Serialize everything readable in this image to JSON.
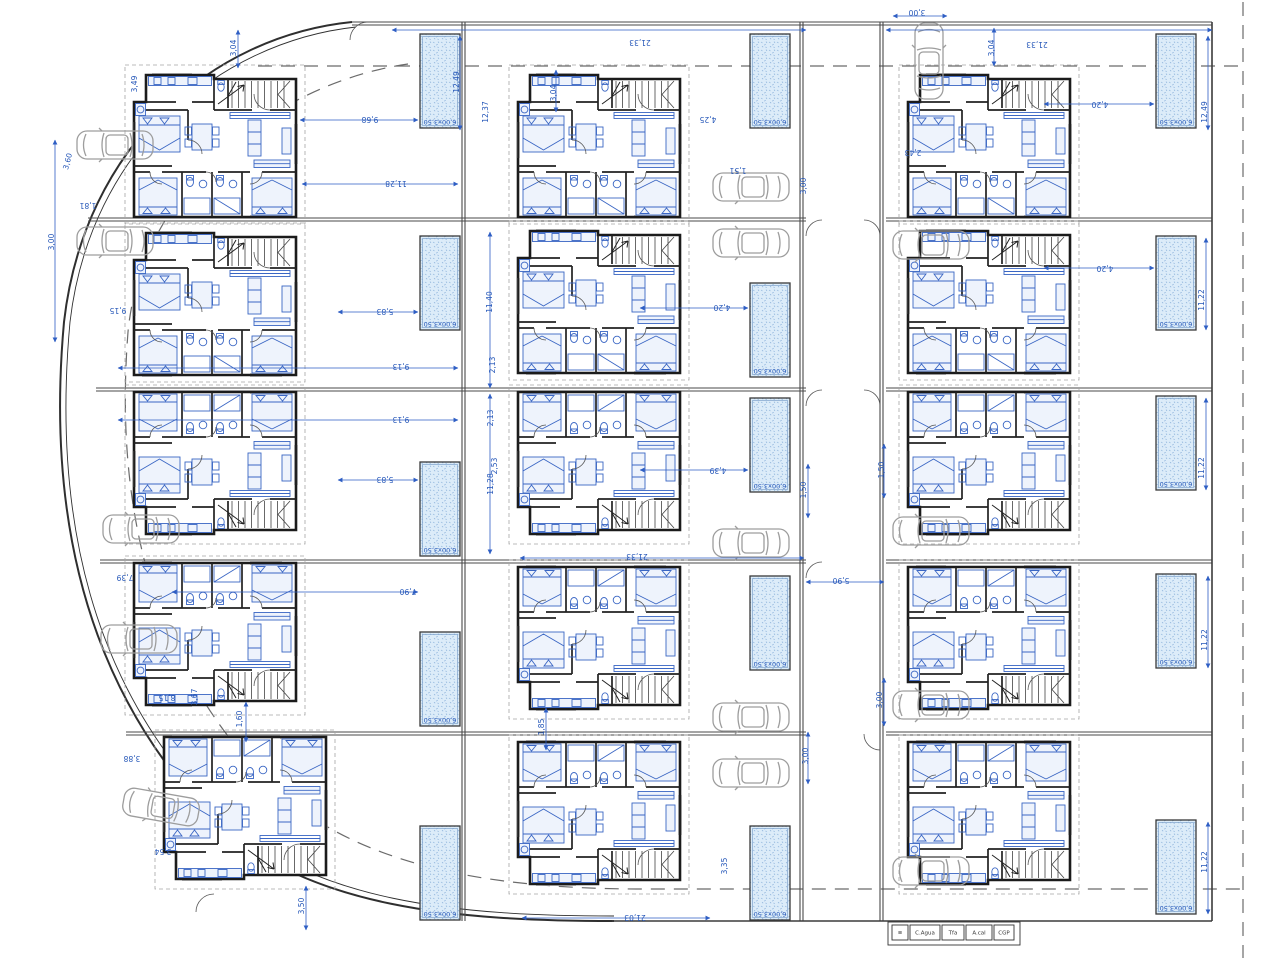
{
  "plan": {
    "width": 1280,
    "height": 960,
    "accent_blue": "#2e5ec4",
    "wall_black": "#1b1b1b",
    "car_gray": "#9d9d9d",
    "pool_fill": "#dcecf9",
    "pool_label": "6,00x3,50"
  },
  "houses": [
    {
      "x": 132,
      "y": 72,
      "flip": "n"
    },
    {
      "x": 132,
      "y": 230,
      "flip": "n"
    },
    {
      "x": 132,
      "y": 392,
      "flip": "v"
    },
    {
      "x": 132,
      "y": 563,
      "flip": "v"
    },
    {
      "x": 162,
      "y": 737,
      "flip": "v"
    },
    {
      "x": 516,
      "y": 72,
      "flip": "n"
    },
    {
      "x": 516,
      "y": 228,
      "flip": "n"
    },
    {
      "x": 516,
      "y": 392,
      "flip": "v"
    },
    {
      "x": 516,
      "y": 567,
      "flip": "v"
    },
    {
      "x": 516,
      "y": 742,
      "flip": "v"
    },
    {
      "x": 906,
      "y": 72,
      "flip": "n"
    },
    {
      "x": 906,
      "y": 228,
      "flip": "n"
    },
    {
      "x": 906,
      "y": 392,
      "flip": "v"
    },
    {
      "x": 906,
      "y": 567,
      "flip": "v"
    },
    {
      "x": 906,
      "y": 742,
      "flip": "v"
    }
  ],
  "cars": [
    {
      "x": 76,
      "y": 128,
      "r": 0
    },
    {
      "x": 76,
      "y": 224,
      "r": 0
    },
    {
      "x": 102,
      "y": 512,
      "r": 0
    },
    {
      "x": 100,
      "y": 622,
      "r": 0
    },
    {
      "x": 122,
      "y": 790,
      "r": 10
    },
    {
      "x": 712,
      "y": 170,
      "r": 0
    },
    {
      "x": 712,
      "y": 226,
      "r": 0
    },
    {
      "x": 712,
      "y": 526,
      "r": 0
    },
    {
      "x": 712,
      "y": 700,
      "r": 0
    },
    {
      "x": 712,
      "y": 756,
      "r": 0
    },
    {
      "x": 890,
      "y": 44,
      "r": 90
    },
    {
      "x": 892,
      "y": 228,
      "r": 0
    },
    {
      "x": 892,
      "y": 514,
      "r": 0
    },
    {
      "x": 892,
      "y": 688,
      "r": 0
    },
    {
      "x": 892,
      "y": 854,
      "r": 0
    }
  ],
  "pools": {
    "w": 40,
    "h": 94,
    "items": [
      {
        "x": 420,
        "y": 34
      },
      {
        "x": 420,
        "y": 236
      },
      {
        "x": 420,
        "y": 462
      },
      {
        "x": 420,
        "y": 632
      },
      {
        "x": 420,
        "y": 826
      },
      {
        "x": 750,
        "y": 34
      },
      {
        "x": 750,
        "y": 283
      },
      {
        "x": 750,
        "y": 398
      },
      {
        "x": 750,
        "y": 576
      },
      {
        "x": 750,
        "y": 826
      },
      {
        "x": 1156,
        "y": 34
      },
      {
        "x": 1156,
        "y": 236
      },
      {
        "x": 1156,
        "y": 396
      },
      {
        "x": 1156,
        "y": 574
      },
      {
        "x": 1156,
        "y": 820
      }
    ]
  },
  "dims": [
    {
      "x": 236,
      "y": 48,
      "t": "3,04",
      "r": -90
    },
    {
      "x": 137,
      "y": 84,
      "t": "3,49",
      "r": -90
    },
    {
      "x": 640,
      "y": 40,
      "t": "21,33",
      "r": 180
    },
    {
      "x": 556,
      "y": 93,
      "t": "3,04",
      "r": -90
    },
    {
      "x": 1037,
      "y": 42,
      "t": "21,33",
      "r": 180
    },
    {
      "x": 994,
      "y": 48,
      "t": "3,04",
      "r": -90
    },
    {
      "x": 917,
      "y": 10,
      "t": "3,00",
      "r": 180
    },
    {
      "x": 70,
      "y": 162,
      "t": "3,60",
      "r": -75
    },
    {
      "x": 88,
      "y": 203,
      "t": "1,81",
      "r": 180
    },
    {
      "x": 54,
      "y": 242,
      "t": "3,00",
      "r": -90
    },
    {
      "x": 370,
      "y": 117,
      "t": "9,68",
      "r": 180
    },
    {
      "x": 396,
      "y": 181,
      "t": "11,28",
      "r": 180
    },
    {
      "x": 385,
      "y": 309,
      "t": "5,83",
      "r": 180
    },
    {
      "x": 401,
      "y": 364,
      "t": "9,13",
      "r": 180
    },
    {
      "x": 401,
      "y": 417,
      "t": "9,13",
      "r": 180
    },
    {
      "x": 385,
      "y": 477,
      "t": "5,83",
      "r": 180
    },
    {
      "x": 408,
      "y": 589,
      "t": "7,90",
      "r": 180
    },
    {
      "x": 738,
      "y": 168,
      "t": "1,51",
      "r": 180
    },
    {
      "x": 806,
      "y": 186,
      "t": "3,00",
      "r": -90
    },
    {
      "x": 841,
      "y": 578,
      "t": "5,90",
      "r": 180
    },
    {
      "x": 637,
      "y": 554,
      "t": "21,33",
      "r": 180
    },
    {
      "x": 635,
      "y": 915,
      "t": "21,03",
      "r": 180
    },
    {
      "x": 544,
      "y": 727,
      "t": "1,85",
      "r": -90
    },
    {
      "x": 242,
      "y": 719,
      "t": "1,60",
      "r": -90
    },
    {
      "x": 132,
      "y": 756,
      "t": "3,88",
      "r": 180
    },
    {
      "x": 163,
      "y": 849,
      "t": "3,54",
      "r": 180
    },
    {
      "x": 304,
      "y": 906,
      "t": "3,50",
      "r": -90
    },
    {
      "x": 459,
      "y": 82,
      "t": "12,49",
      "r": -90
    },
    {
      "x": 1207,
      "y": 112,
      "t": "12,49",
      "r": -90
    },
    {
      "x": 1204,
      "y": 300,
      "t": "11,22",
      "r": -90
    },
    {
      "x": 1204,
      "y": 468,
      "t": "11,22",
      "r": -90
    },
    {
      "x": 1207,
      "y": 640,
      "t": "11,22",
      "r": -90
    },
    {
      "x": 1207,
      "y": 862,
      "t": "11,22",
      "r": -90
    },
    {
      "x": 806,
      "y": 490,
      "t": "1,50",
      "r": -90
    },
    {
      "x": 808,
      "y": 756,
      "t": "3,00",
      "r": -90
    },
    {
      "x": 884,
      "y": 470,
      "t": "1,50",
      "r": -90
    },
    {
      "x": 882,
      "y": 700,
      "t": "3,00",
      "r": -90
    },
    {
      "x": 118,
      "y": 308,
      "t": "9,15",
      "r": 180
    },
    {
      "x": 488,
      "y": 112,
      "t": "12,37",
      "r": -90
    },
    {
      "x": 492,
      "y": 302,
      "t": "11,40",
      "r": -90
    },
    {
      "x": 495,
      "y": 365,
      "t": "2,13",
      "r": -90
    },
    {
      "x": 493,
      "y": 418,
      "t": "2,13",
      "r": -90
    },
    {
      "x": 497,
      "y": 466,
      "t": "2,53",
      "r": -90
    },
    {
      "x": 493,
      "y": 484,
      "t": "11,28",
      "r": -90
    },
    {
      "x": 722,
      "y": 305,
      "t": "4,20",
      "r": 180
    },
    {
      "x": 718,
      "y": 468,
      "t": "4,39",
      "r": 180
    },
    {
      "x": 1100,
      "y": 102,
      "t": "4,20",
      "r": 180
    },
    {
      "x": 1105,
      "y": 266,
      "t": "4,20",
      "r": 180
    },
    {
      "x": 913,
      "y": 150,
      "t": "2,43",
      "r": 180
    },
    {
      "x": 708,
      "y": 117,
      "t": "4,25",
      "r": 180
    },
    {
      "x": 167,
      "y": 695,
      "t": "8,15",
      "r": 180
    },
    {
      "x": 197,
      "y": 697,
      "t": "3,67",
      "r": -90
    },
    {
      "x": 125,
      "y": 575,
      "t": "7,39",
      "r": 180
    },
    {
      "x": 727,
      "y": 866,
      "t": "3,35",
      "r": -90
    }
  ],
  "dimlines": [
    [
      392,
      30,
      806,
      30
    ],
    [
      886,
      30,
      1212,
      30
    ],
    [
      238,
      30,
      238,
      68
    ],
    [
      556,
      70,
      556,
      112
    ],
    [
      994,
      28,
      994,
      66
    ],
    [
      893,
      16,
      947,
      16
    ],
    [
      300,
      120,
      418,
      120
    ],
    [
      302,
      184,
      458,
      184
    ],
    [
      55,
      140,
      55,
      342
    ],
    [
      338,
      312,
      418,
      312
    ],
    [
      118,
      368,
      458,
      368
    ],
    [
      118,
      420,
      458,
      420
    ],
    [
      338,
      480,
      418,
      480
    ],
    [
      172,
      592,
      418,
      592
    ],
    [
      640,
      308,
      748,
      308
    ],
    [
      640,
      470,
      748,
      470
    ],
    [
      1044,
      104,
      1154,
      104
    ],
    [
      1044,
      268,
      1154,
      268
    ],
    [
      806,
      582,
      884,
      582
    ],
    [
      520,
      558,
      804,
      558
    ],
    [
      522,
      918,
      710,
      918
    ],
    [
      246,
      702,
      246,
      742
    ],
    [
      306,
      886,
      306,
      930
    ],
    [
      546,
      708,
      546,
      750
    ],
    [
      884,
      444,
      884,
      498
    ],
    [
      884,
      678,
      884,
      726
    ],
    [
      808,
      464,
      808,
      518
    ],
    [
      808,
      732,
      808,
      784
    ],
    [
      460,
      36,
      460,
      130
    ],
    [
      1208,
      36,
      1208,
      130
    ],
    [
      1206,
      238,
      1206,
      330
    ],
    [
      1206,
      398,
      1206,
      490
    ],
    [
      1208,
      576,
      1208,
      668
    ],
    [
      1208,
      822,
      1208,
      914
    ],
    [
      490,
      232,
      490,
      388
    ],
    [
      490,
      394,
      490,
      554
    ]
  ],
  "site": {
    "outer": "M352,22 C212,36 84,146 64,322 C46,520 88,692 216,822 C310,908 456,921 614,921",
    "outer2": "M356,27 C218,42 90,150 70,322 C52,518 92,688 220,816 C312,902 458,916 614,916",
    "lotlines": [
      [
        88,
        218,
        806,
        218
      ],
      [
        96,
        388,
        806,
        388
      ],
      [
        100,
        560,
        806,
        560
      ],
      [
        126,
        732,
        806,
        732
      ],
      [
        886,
        218,
        1212,
        218
      ],
      [
        886,
        388,
        1212,
        388
      ],
      [
        886,
        560,
        1212,
        560
      ],
      [
        886,
        732,
        1212,
        732
      ],
      [
        462,
        22,
        462,
        921
      ],
      [
        800,
        22,
        800,
        921
      ],
      [
        880,
        22,
        880,
        921
      ],
      [
        352,
        22,
        1212,
        22
      ]
    ],
    "singles": [
      [
        612,
        921,
        1212,
        921
      ],
      [
        1212,
        22,
        1212,
        921
      ]
    ],
    "dashed": [
      "M258,66 L1242,66",
      "M1243,2 L1243,958",
      "M408,64 C282,82 142,182 128,332 C114,510 154,664 264,778 C344,860 472,889 642,889 L1242,889"
    ],
    "arcs": [
      "M806,236 A16,16 0 0,1 822,220",
      "M806,406 A16,16 0 0,1 822,390",
      "M806,578 A16,16 0 0,1 822,562",
      "M880,236 A16,16 0 0,0 864,220",
      "M880,406 A16,16 0 0,0 864,390",
      "M880,750 A16,16 0 0,1 864,734",
      "M196,912 A18,18 0 0,1 214,894",
      "M368,22 A18,18 0 0,0 350,40"
    ]
  },
  "legend": {
    "x": 892,
    "y": 925,
    "h": 15,
    "items": [
      {
        "label": "≡",
        "w": 16
      },
      {
        "label": "C.Agua",
        "w": 30
      },
      {
        "label": "Tfa",
        "w": 22
      },
      {
        "label": "A.cal",
        "w": 26
      },
      {
        "label": "CGP",
        "w": 20
      }
    ]
  }
}
